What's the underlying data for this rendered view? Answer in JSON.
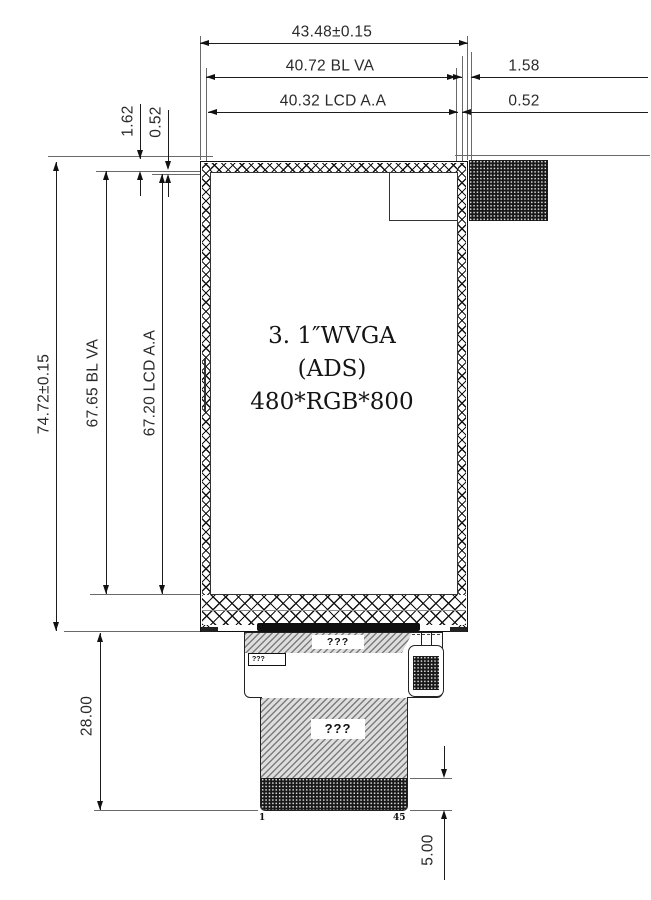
{
  "dims": {
    "top": {
      "overall": "43.48±0.15",
      "bl": "40.72  BL  VA",
      "lcd": "40.32  LCD  A.A",
      "right1": "1.58",
      "right2": "0.52"
    },
    "left_top": {
      "a": "1.62",
      "b": "0.52"
    },
    "left": {
      "overall": "74.72±0.15",
      "bl": "67.65  BL  VA",
      "lcd": "67.20  LCD  A.A"
    },
    "bottom": {
      "fpc": "28.00",
      "contact": "5.00"
    }
  },
  "panel": {
    "line1": "3. 1″WVGA",
    "line2": "(ADS)",
    "line3": "480*RGB*800"
  },
  "fpc": {
    "strip_label": "???",
    "box_label": "???",
    "tail_label": "???",
    "pin_first": "1",
    "pin_last": "45"
  }
}
